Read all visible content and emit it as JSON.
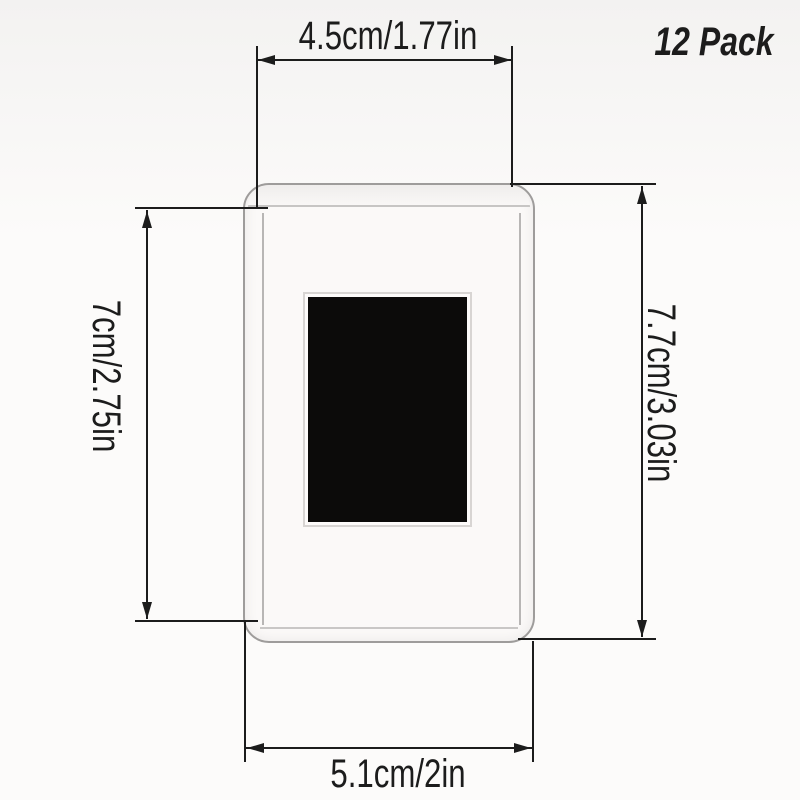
{
  "badge": {
    "text": "12 Pack"
  },
  "dimensions": {
    "top": {
      "label": "4.5cm/1.77in"
    },
    "left": {
      "label": "7cm/2.75in"
    },
    "right": {
      "label": "7.7cm/3.03in"
    },
    "bottom": {
      "label": "5.1cm/2in"
    }
  },
  "colors": {
    "line": "#1c1c1c",
    "text": "#1c1c1c",
    "frame-border": "#9e9c9b",
    "frame-fill": "#fbf9f8",
    "frame-lip": "#b8b6b5",
    "photo-window": "#0c0b0a",
    "bg-top": "#f3f2f1",
    "bg-bottom": "#fcfbfa"
  }
}
